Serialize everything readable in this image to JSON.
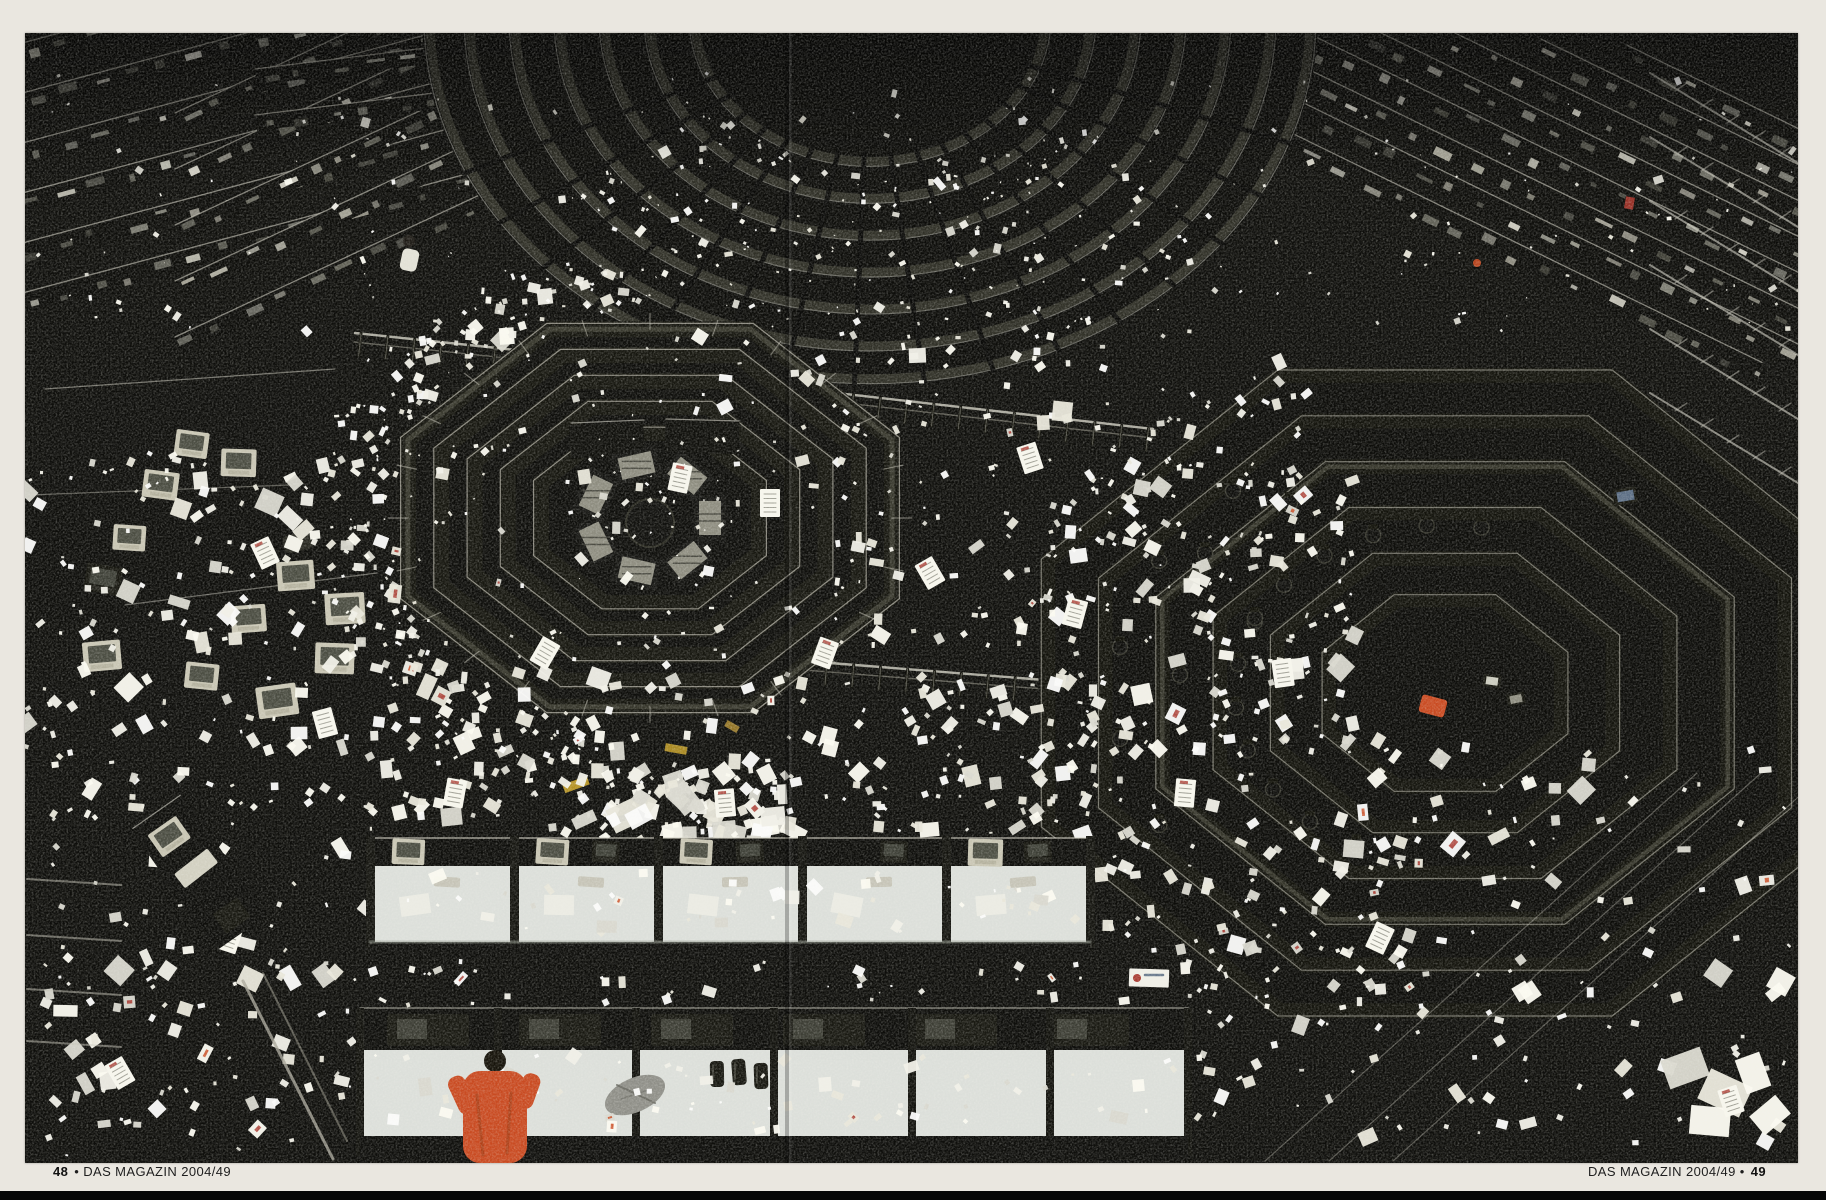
{
  "page": {
    "background_color": "#eae7e0",
    "scan_edge_color": "#060606",
    "captions": {
      "left_page_number": "48",
      "left_text": "• DAS MAGAZIN 2004/49",
      "right_text": "DAS MAGAZIN 2004/49 •",
      "right_page_number": "49"
    }
  },
  "photo": {
    "description": "Bird's-eye photograph of the Chicago Board of Trade trading floor spread across two magazine pages: octagonal trading pits with tiered black desks, railings and monitors, the dark waffle-pattern floor blanketed with scattered white order slips; at the bottom a row of white clerk desks with CRT monitors and phones, one clerk in a bright orange jacket leaning over the desk.",
    "palette": {
      "photo_black": "#0b0b09",
      "structure_dark": "#101010",
      "edge_light": "#d8d6ca",
      "paper_white": "#f5f4ec",
      "paper_shadow": "#cfcec4",
      "desk_white": "#dfe3de",
      "monitor_beige": "#cbc8b6",
      "screen_dark": "#3c3e36",
      "screen_glow": "#8f8e82",
      "accent_orange": "#cc4a20",
      "accent_red": "#a8332a",
      "accent_yellow": "#c9a227",
      "accent_blue": "#5b6e86",
      "floor_dot": "#26261f"
    }
  }
}
